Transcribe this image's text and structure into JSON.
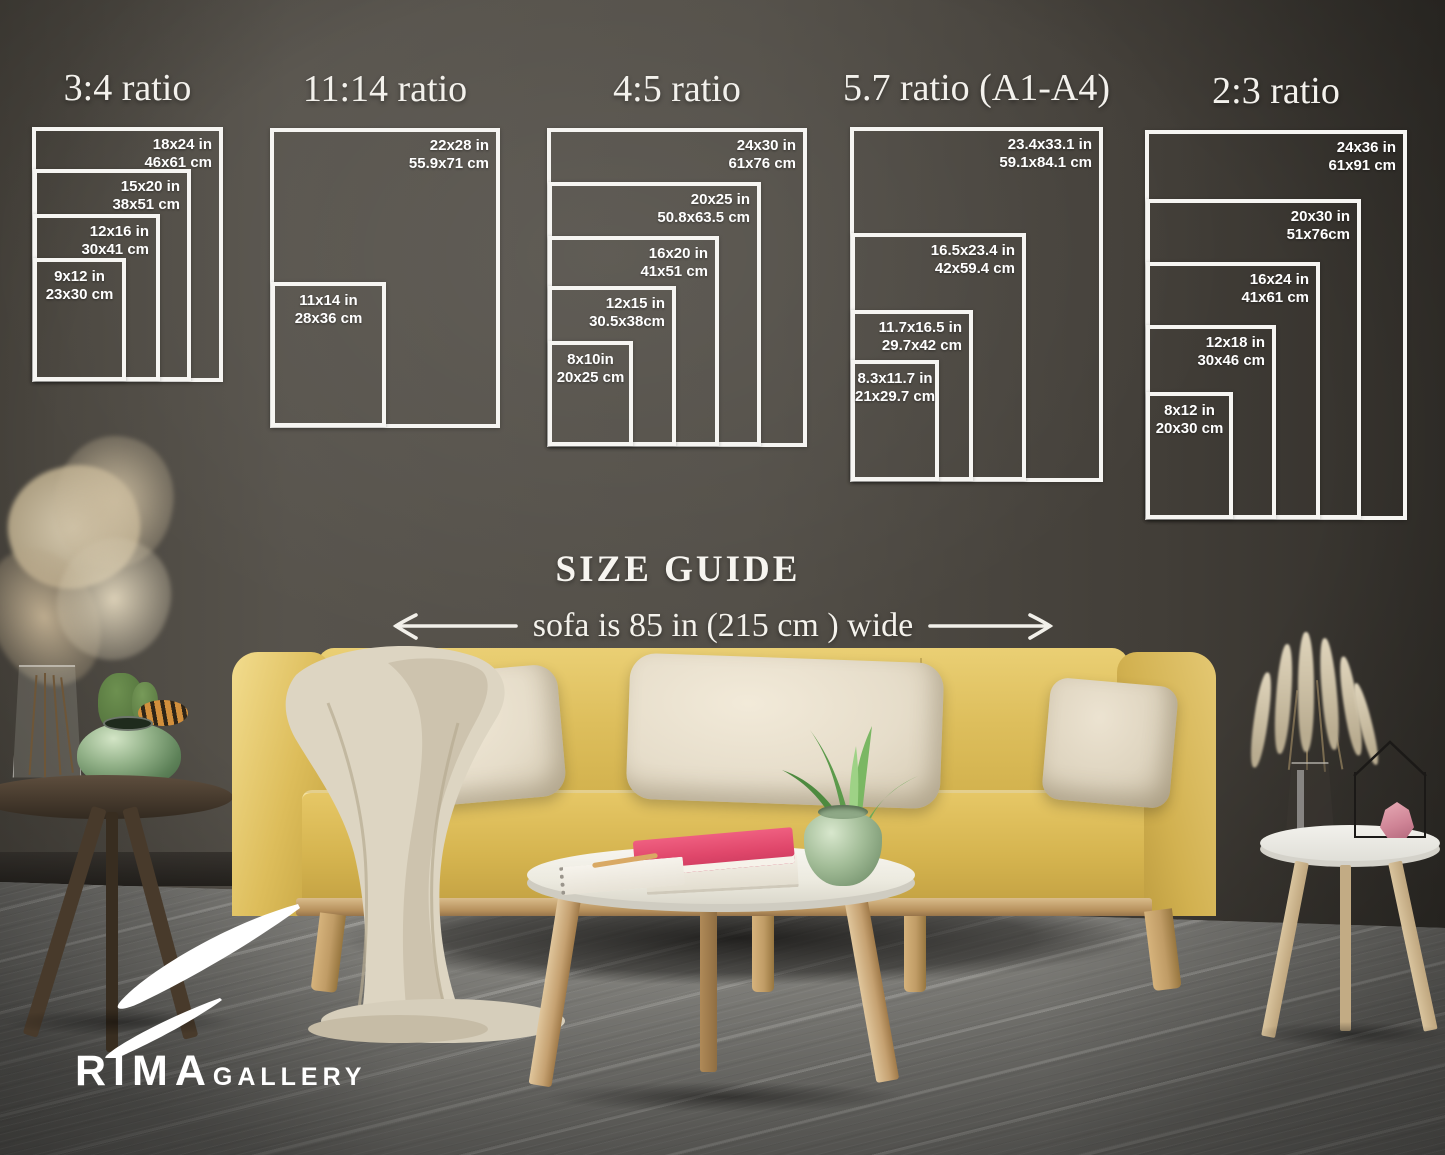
{
  "size_guide": {
    "heading": "SIZE GUIDE",
    "sofa_note": "sofa is 85 in (215 cm ) wide",
    "groups": [
      {
        "title": "3:4 ratio",
        "sizes": [
          {
            "inches": "18x24 in",
            "cm": "46x61 cm"
          },
          {
            "inches": "15x20 in",
            "cm": "38x51 cm"
          },
          {
            "inches": "12x16 in",
            "cm": "30x41 cm"
          },
          {
            "inches": "9x12 in",
            "cm": "23x30 cm"
          }
        ]
      },
      {
        "title": "11:14 ratio",
        "sizes": [
          {
            "inches": "22x28 in",
            "cm": "55.9x71 cm"
          },
          {
            "inches": "11x14 in",
            "cm": "28x36 cm"
          }
        ]
      },
      {
        "title": "4:5 ratio",
        "sizes": [
          {
            "inches": "24x30 in",
            "cm": "61x76 cm"
          },
          {
            "inches": "20x25 in",
            "cm": "50.8x63.5 cm"
          },
          {
            "inches": "16x20 in",
            "cm": "41x51 cm"
          },
          {
            "inches": "12x15 in",
            "cm": "30.5x38cm"
          },
          {
            "inches": "8x10in",
            "cm": "20x25 cm"
          }
        ]
      },
      {
        "title": "5.7 ratio (A1-A4)",
        "sizes": [
          {
            "inches": "23.4x33.1 in",
            "cm": "59.1x84.1 cm"
          },
          {
            "inches": "16.5x23.4 in",
            "cm": "42x59.4 cm"
          },
          {
            "inches": "11.7x16.5 in",
            "cm": "29.7x42 cm"
          },
          {
            "inches": "8.3x11.7 in",
            "cm": "21x29.7 cm"
          }
        ]
      },
      {
        "title": "2:3 ratio",
        "sizes": [
          {
            "inches": "24x36 in",
            "cm": "61x91 cm"
          },
          {
            "inches": "20x30 in",
            "cm": "51x76cm"
          },
          {
            "inches": "16x24 in",
            "cm": "41x61 cm"
          },
          {
            "inches": "12x18 in",
            "cm": "30x46 cm"
          },
          {
            "inches": "8x12 in",
            "cm": "20x30 cm"
          }
        ]
      }
    ]
  },
  "logo": {
    "brand": "RIMA",
    "suffix": "GALLERY"
  },
  "colors": {
    "frame": "#f6f5f2",
    "wall": "#4c4741",
    "sofa_yellow": "#dcbc56",
    "pillow_cream": "#eae2d1",
    "floor_gray": "#8b8a85",
    "book_pink": "#e8476f",
    "logo_white": "#ffffff"
  }
}
